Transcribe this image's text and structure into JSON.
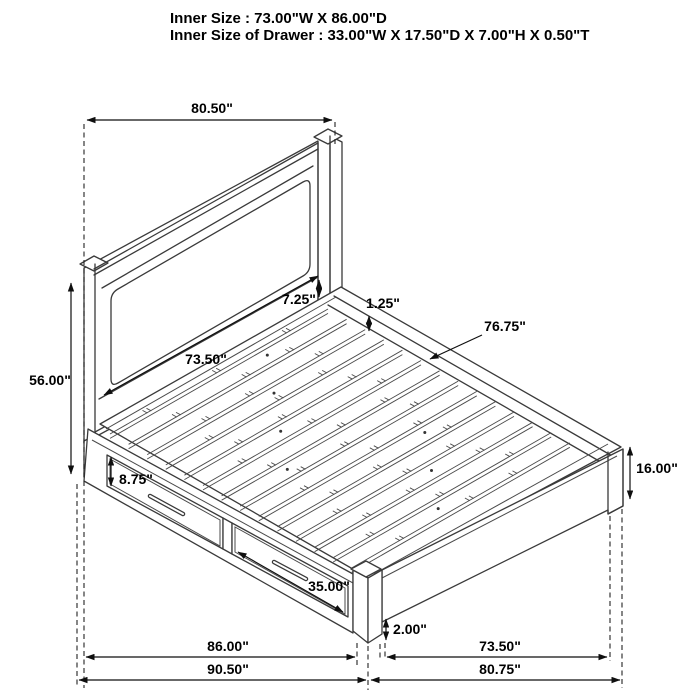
{
  "title": {
    "line1": "Inner Size : 73.00\"W X 86.00\"D",
    "line2": "Inner Size of Drawer : 33.00\"W X 17.50\"D X 7.00\"H X 0.50\"T"
  },
  "dims": {
    "headboard_width": "80.50\"",
    "headboard_height": "56.00\"",
    "headboard_panel_width": "73.50\"",
    "panel_to_deck_gap": "7.25\"",
    "slat_recess": "1.25\"",
    "slat_length": "76.75\"",
    "drawer_front_height": "8.75\"",
    "drawer_front_width": "35.00\"",
    "footboard_height": "16.00\"",
    "base_clearance": "2.00\"",
    "side_inner_depth": "86.00\"",
    "foot_inner_width": "73.50\"",
    "overall_depth": "90.50\"",
    "overall_width": "80.75\""
  },
  "colors": {
    "structure_line": "#3a3a3a",
    "dimension_line": "#0f0f0f",
    "text": "#000000",
    "background": "#ffffff"
  }
}
